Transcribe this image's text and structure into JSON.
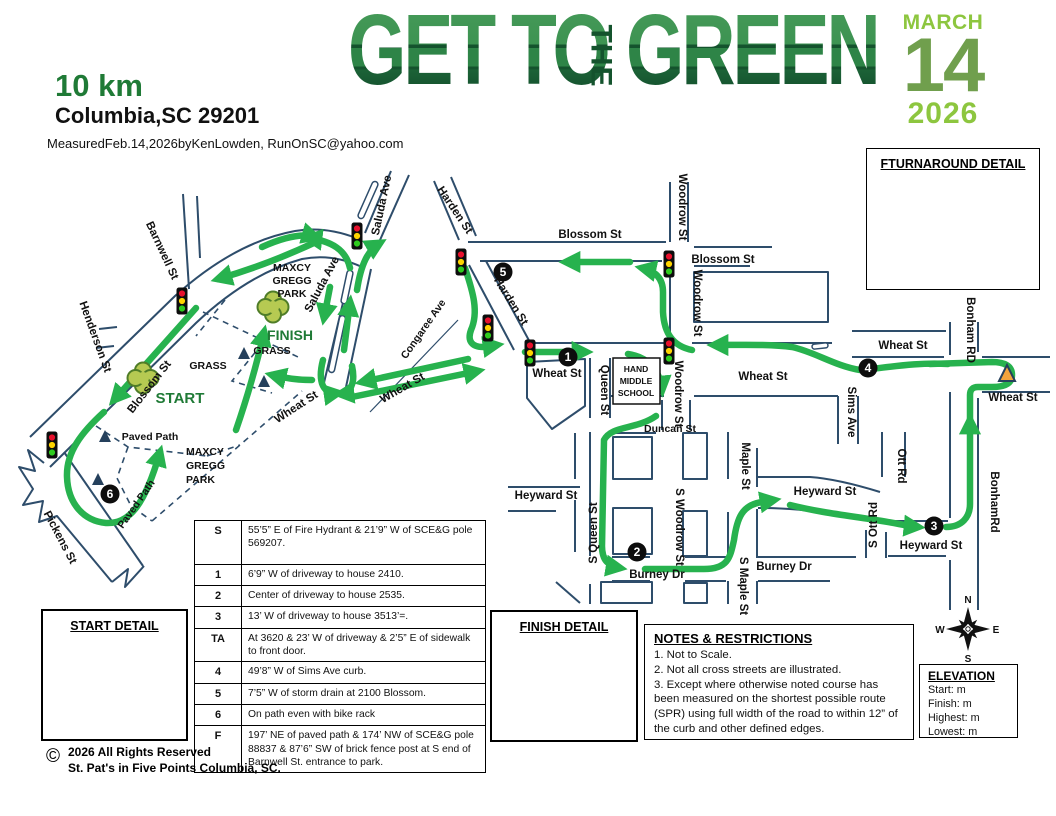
{
  "colors": {
    "route_green": "#27b24e",
    "street_navy": "#2e4d6b",
    "logo_dark_green": "#14532d",
    "logo_mid_green": "#2e8447",
    "date_light_green": "#8dc63f",
    "date_mid_green": "#709f4d",
    "accent_green": "#1f7a36",
    "cone_orange": "#f2a33c",
    "clover_green": "#b6ca52"
  },
  "header": {
    "distance": "10 km",
    "location": "Columbia,SC 29201",
    "measured_line": "MeasuredFeb.14,2026byKenLowden, RunOnSC@yahoo.com",
    "logo": {
      "part1": "GET TO",
      "part2": "THE",
      "part3": "GREEN"
    },
    "date": {
      "month": "MARCH",
      "day": "14",
      "year": "2026"
    }
  },
  "map": {
    "labels": {
      "barnwell": "Barnwell St",
      "henderson": "Henderson St",
      "blossom": "Blossom St",
      "pickens": "Pickens St",
      "saluda": "Saluda Ave",
      "harden": "Harden St",
      "woodrow": "Woodrow St",
      "s_woodrow": "S Woodrow St",
      "wheat": "Wheat St",
      "congaree": "Congaree Ave",
      "queen": "Queen St",
      "s_queen": "S Queen St",
      "duncan": "Duncan St",
      "heyward": "Heyward St",
      "burney": "Burney Dr",
      "maple": "Maple St",
      "s_maple": "S Maple St",
      "sims": "Sims Ave",
      "ott": "Ott Rd",
      "s_ott": "S Ott Rd",
      "bonham_upper": "Bonham RD",
      "bonham_lower": "BonhamRd",
      "paved_path": "Paved Path",
      "maxcy": "MAXCY",
      "gregg": "GREGG",
      "park": "PARK",
      "grass": "GRASS",
      "start": "START",
      "finish": "FINISH",
      "school_1": "HAND",
      "school_2": "MIDDLE",
      "school_3": "SCHOOL"
    },
    "markers": {
      "m1": "1",
      "m2": "2",
      "m3": "3",
      "m4": "4",
      "m5": "5",
      "m6": "6"
    }
  },
  "detail_boxes": {
    "turnaround": "FTURNAROUND DETAIL",
    "start": "START DETAIL",
    "finish": "FINISH DETAIL"
  },
  "split_table": {
    "rows": [
      {
        "label": "S",
        "desc": "55’5” E of Fire Hydrant & 21’9” W of SCE&G pole 569207."
      },
      {
        "label": "1",
        "desc": "6’9” W of driveway to house 2410."
      },
      {
        "label": "2",
        "desc": "Center of driveway to house 2535."
      },
      {
        "label": "3",
        "desc": "13’ W of driveway to house 3513’=."
      },
      {
        "label": "TA",
        "desc": "At 3620 & 23’ W of driveway & 2’5” E of sidewalk to front door."
      },
      {
        "label": "4",
        "desc": "49’8” W of Sims Ave curb."
      },
      {
        "label": "5",
        "desc": "7’5” W of storm drain at 2100 Blossom."
      },
      {
        "label": "6",
        "desc": "On path even with bike rack"
      },
      {
        "label": "F",
        "desc": "197’ NE of paved path & 174’ NW of SCE&G pole 88837 & 87’6” SW of brick fence post at S end of Barnwell St. entrance to park."
      }
    ]
  },
  "notes": {
    "title": "NOTES & RESTRICTIONS",
    "items": [
      "1. Not to Scale.",
      "2. Not all cross streets are illustrated.",
      "3. Except where otherwise noted course has been measured on the shortest possible route (SPR) using full width of the road to within 12” of the curb and other defined edges."
    ]
  },
  "elevation": {
    "title": "ELEVATION",
    "items": [
      "Start: m",
      "Finish: m",
      "Highest: m",
      "Lowest: m"
    ]
  },
  "compass": {
    "n": "N",
    "e": "E",
    "s": "S",
    "w": "W"
  },
  "copyright": {
    "mark": "©",
    "line1": "2026 All Rights Reserved",
    "line2": "St. Pat's in Five Points Columbia, SC."
  }
}
